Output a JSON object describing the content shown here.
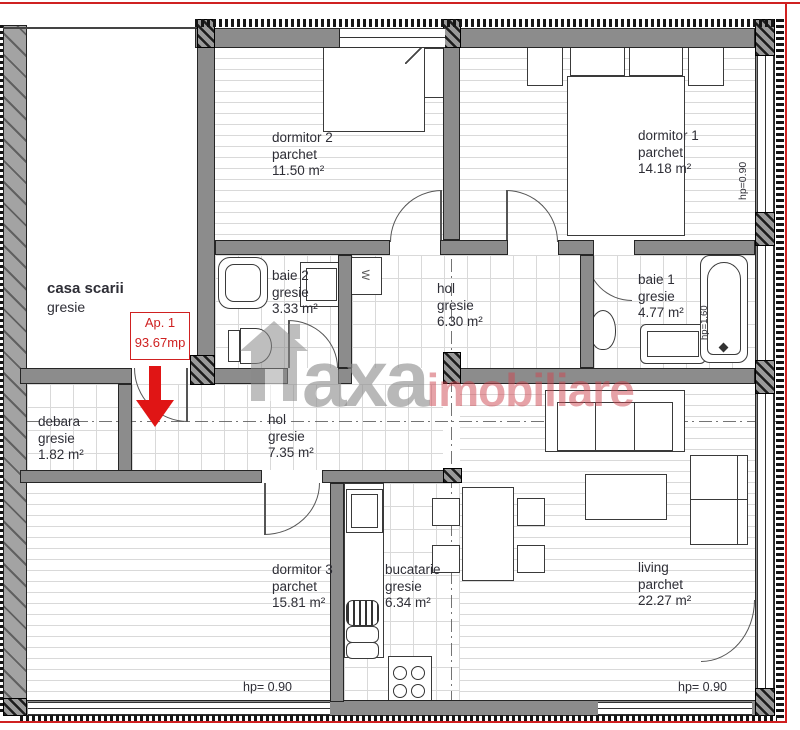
{
  "plan": {
    "title": "apartment floor plan",
    "apartment_badge": {
      "line1": "Ap. 1",
      "line2": "93.67mp"
    },
    "watermark": {
      "brand_gray": "axa",
      "brand_red": "imobiliare"
    },
    "rooms": [
      {
        "id": "dormitor2",
        "name": "dormitor 2",
        "finish": "parchet",
        "area": "11.50 m²"
      },
      {
        "id": "dormitor1",
        "name": "dormitor 1",
        "finish": "parchet",
        "area": "14.18 m²"
      },
      {
        "id": "baie2",
        "name": "baie 2",
        "finish": "gresie",
        "area": "3.33 m²"
      },
      {
        "id": "hol6",
        "name": "hol",
        "finish": "gresie",
        "area": "6.30 m²"
      },
      {
        "id": "baie1",
        "name": "baie 1",
        "finish": "gresie",
        "area": "4.77 m²"
      },
      {
        "id": "casa_scarii",
        "name": "casa scarii",
        "finish": "gresie",
        "area": ""
      },
      {
        "id": "debara",
        "name": "debara",
        "finish": "gresie",
        "area": "1.82 m²"
      },
      {
        "id": "hol7",
        "name": "hol",
        "finish": "gresie",
        "area": "7.35 m²"
      },
      {
        "id": "dormitor3",
        "name": "dormitor 3",
        "finish": "parchet",
        "area": "15.81 m²"
      },
      {
        "id": "bucatarie",
        "name": "bucatarie",
        "finish": "gresie",
        "area": "6.34 m²"
      },
      {
        "id": "living",
        "name": "living",
        "finish": "parchet",
        "area": "22.27 m²"
      }
    ],
    "annotations": {
      "hp_bottom_left": "hp= 0.90",
      "hp_bottom_right": "hp= 0.90",
      "hp_right_wall": "hp=0.90",
      "hp_bathtub": "hp=1.60",
      "washing_machine": "W"
    },
    "colors": {
      "wall_gray": "#8c8c8c",
      "line_dark": "#262626",
      "red_accent": "#cf2121",
      "floor_line": "#d9d9d9",
      "watermark_gray": "#8c8c8c",
      "watermark_red": "#cd4650"
    }
  }
}
